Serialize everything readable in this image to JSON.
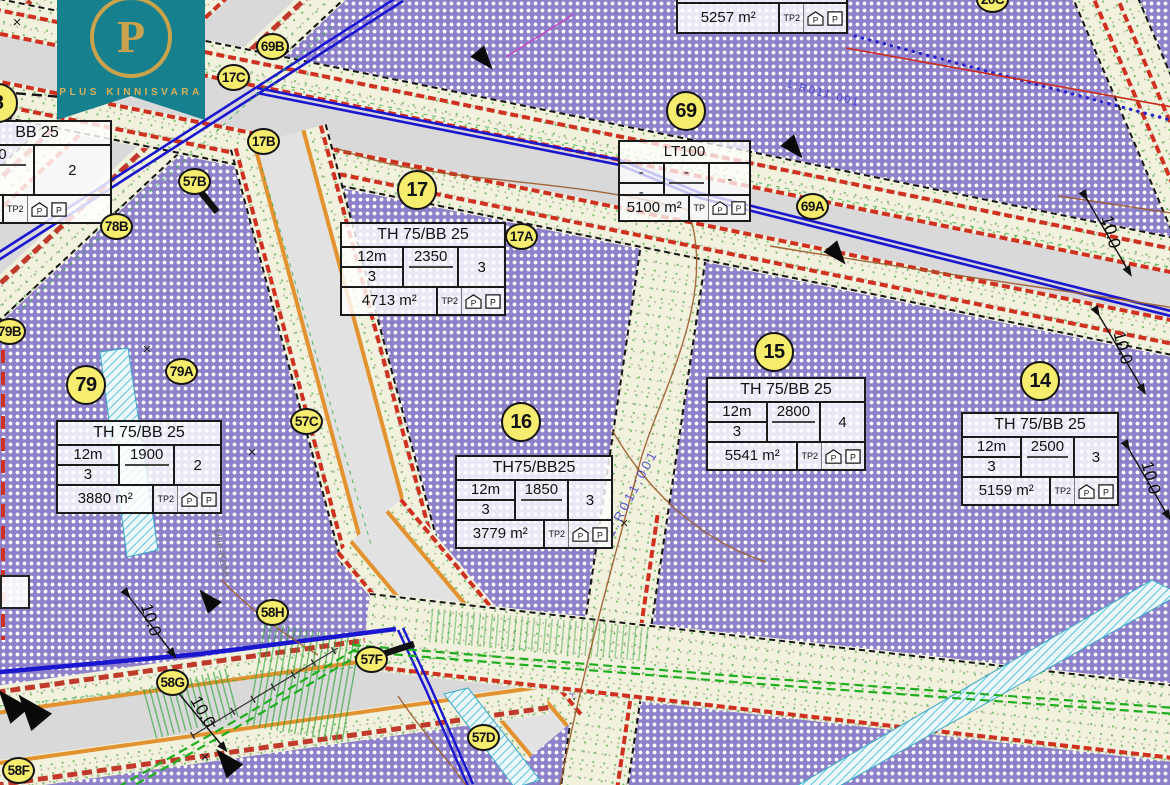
{
  "logo": {
    "company": "PLUS KINNISVARA",
    "monogram": "P"
  },
  "colors": {
    "plot_purple": "#8e81c9",
    "verge": "#f2f1de",
    "asphalt": "#d9d9d9",
    "marker_yellow": "#f6ec6e",
    "logo_teal": "#17808f",
    "logo_gold": "#c9a24b",
    "utility_blue": "#1a17cf",
    "utility_green": "#25ad25",
    "setback_red": "#cf3020",
    "edge_orange": "#e2922e",
    "contour_brown": "#9a5b2b",
    "hatch_cyan": "#5ec4dc"
  },
  "markers": [
    {
      "label": "69B"
    },
    {
      "label": "17C"
    },
    {
      "label": "17B"
    },
    {
      "label": "57B"
    },
    {
      "label": "78B"
    },
    {
      "label": "79B"
    },
    {
      "label": "79A"
    },
    {
      "label": "57C"
    },
    {
      "label": "17A"
    },
    {
      "label": "69A"
    },
    {
      "label": "58H"
    },
    {
      "label": "58G"
    },
    {
      "label": "57F"
    },
    {
      "label": "57D"
    },
    {
      "label": "58F"
    },
    {
      "label": "20C"
    },
    {
      "label": "79"
    },
    {
      "label": "17"
    },
    {
      "label": "69"
    },
    {
      "label": "16"
    },
    {
      "label": "15"
    },
    {
      "label": "14"
    },
    {
      "label": "8"
    }
  ],
  "tables": {
    "t17": {
      "title": "TH 75/BB 25",
      "height": "12m",
      "floors": "3",
      "build_area": "2350",
      "units": "3",
      "area": "4713 m²",
      "tp": "TP2",
      "p_house": "P",
      "p_lot": "P"
    },
    "t79": {
      "title": "TH 75/BB 25",
      "height": "12m",
      "floors": "3",
      "build_area": "1900",
      "units": "2",
      "area": "3880 m²",
      "tp": "TP2",
      "p_house": "P",
      "p_lot": "P"
    },
    "t16": {
      "title": "TH75/BB25",
      "height": "12m",
      "floors": "3",
      "build_area": "1850",
      "units": "3",
      "area": "3779 m²",
      "tp": "TP2",
      "p_house": "P",
      "p_lot": "P"
    },
    "t15": {
      "title": "TH 75/BB 25",
      "height": "12m",
      "floors": "3",
      "build_area": "2800",
      "units": "4",
      "area": "5541 m²",
      "tp": "TP2",
      "p_house": "P",
      "p_lot": "P"
    },
    "t14": {
      "title": "TH 75/BB 25",
      "height": "12m",
      "floors": "3",
      "build_area": "2500",
      "units": "3",
      "area": "5159 m²",
      "tp": "TP2",
      "p_house": "P",
      "p_lot": "P"
    },
    "tlt": {
      "title": "LT100",
      "c1_top": "-",
      "c1_bot": "-",
      "c2": "-",
      "c3": "-",
      "area": "5100 m²",
      "tp": "TP",
      "p_house": "P",
      "p_lot": "P"
    },
    "ttop": {
      "area": "5257 m²",
      "tp": "TP2",
      "p_house": "P",
      "p_lot": "P"
    },
    "ttl": {
      "title": "BB 25",
      "build_area": "00",
      "units": "2",
      "tp": "TP2",
      "p_house": "P",
      "p_lot": "P"
    }
  },
  "dims": [
    "10.0",
    "10.0",
    "10.0",
    "10.0",
    "10.0"
  ],
  "labels": {
    "street": "Uue-Kose",
    "cadastral_1": "11:R011:001",
    "cadastral_2": "1:R011:001"
  }
}
